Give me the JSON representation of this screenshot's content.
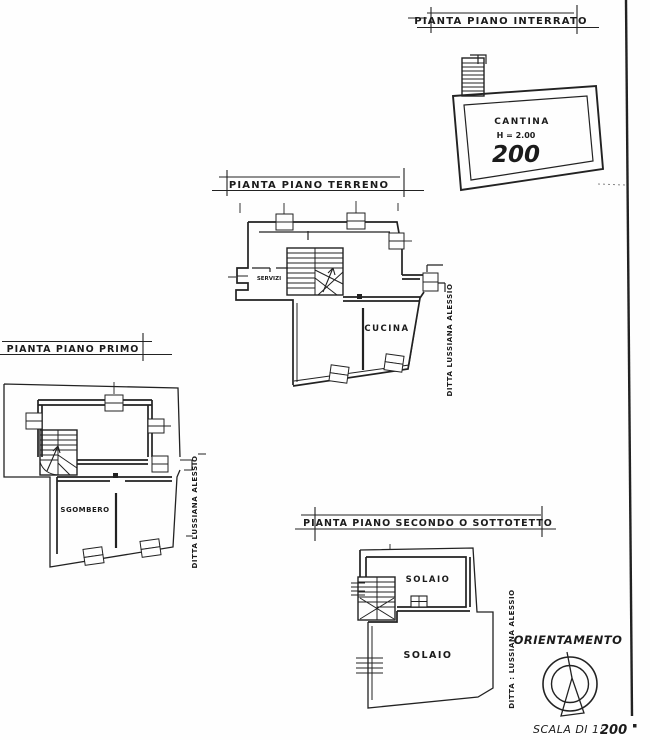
{
  "sheet": {
    "background": "#fefefe",
    "ink_color": "#222222"
  },
  "plans": {
    "interrato": {
      "title": "PIANTA PIANO INTERRATO",
      "room": "CANTINA",
      "height_note": "H = 2.00",
      "height_value": "200"
    },
    "terreno": {
      "title": "PIANTA PIANO TERRENO",
      "kitchen_label": "CUCINA",
      "small_room_label": "SERVIZI",
      "side_note": "DITTA LUSSIANA ALESSIO"
    },
    "primo": {
      "title": "PIANTA PIANO PRIMO",
      "storage_label": "SGOMBERO",
      "side_note": "DITTA LUSSIANA ALESSIO"
    },
    "secondo": {
      "title": "PIANTA PIANO SECONDO O SOTTOTETTO",
      "attic_upper_label": "SOLAIO",
      "attic_lower_label": "SOLAIO",
      "side_note": "DITTA : LUSSIANA ALESSIO"
    }
  },
  "legend": {
    "orientation_label": "ORIENTAMENTO",
    "scale_prefix": "SCALA DI 1:",
    "scale_value": "200"
  }
}
